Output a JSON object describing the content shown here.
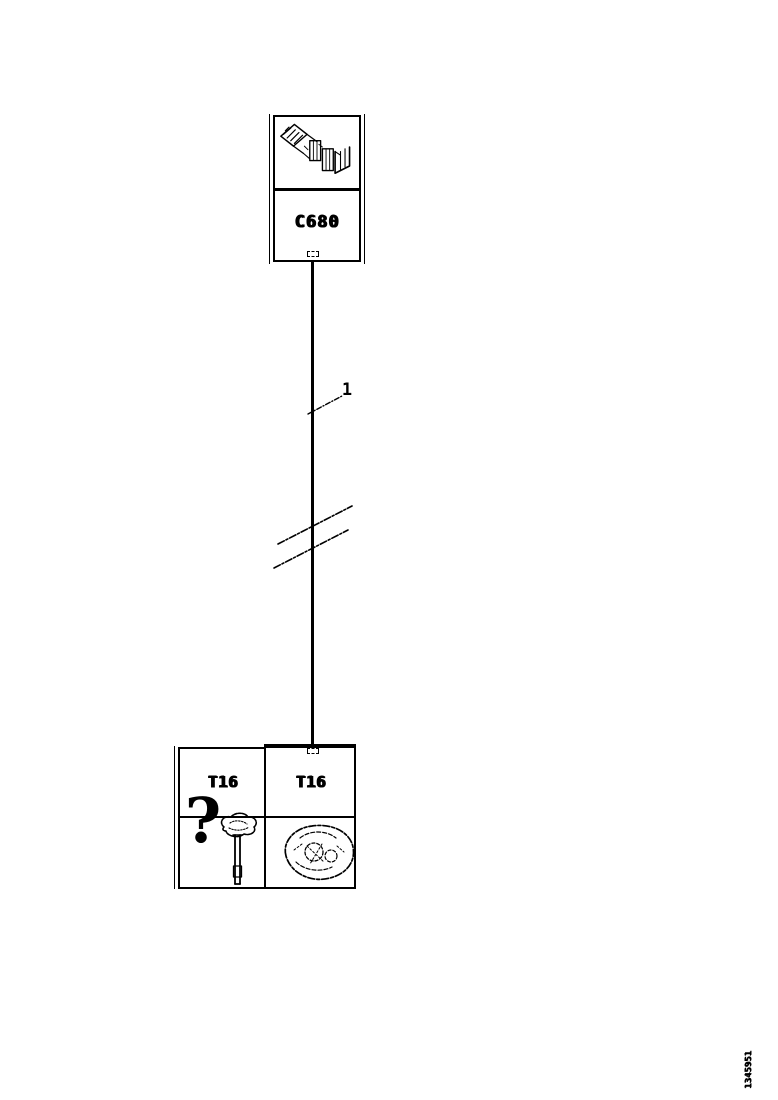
{
  "meta": {
    "background_color": "#ffffff",
    "ink_color": "#000000",
    "diagram_type": "wiring-harness-route-diagram"
  },
  "top_box": {
    "connector_label": "C680",
    "image_icon": "connector-strip-drawing"
  },
  "wire": {
    "callout_label": "1"
  },
  "grid": {
    "left_top_label": "T16",
    "right_top_label": "T16",
    "question_mark_glyph": "?",
    "probe_icon": "test-probe-icon",
    "component_icon": "round-component-drawing"
  },
  "footer": {
    "corner_number": "1345951"
  }
}
